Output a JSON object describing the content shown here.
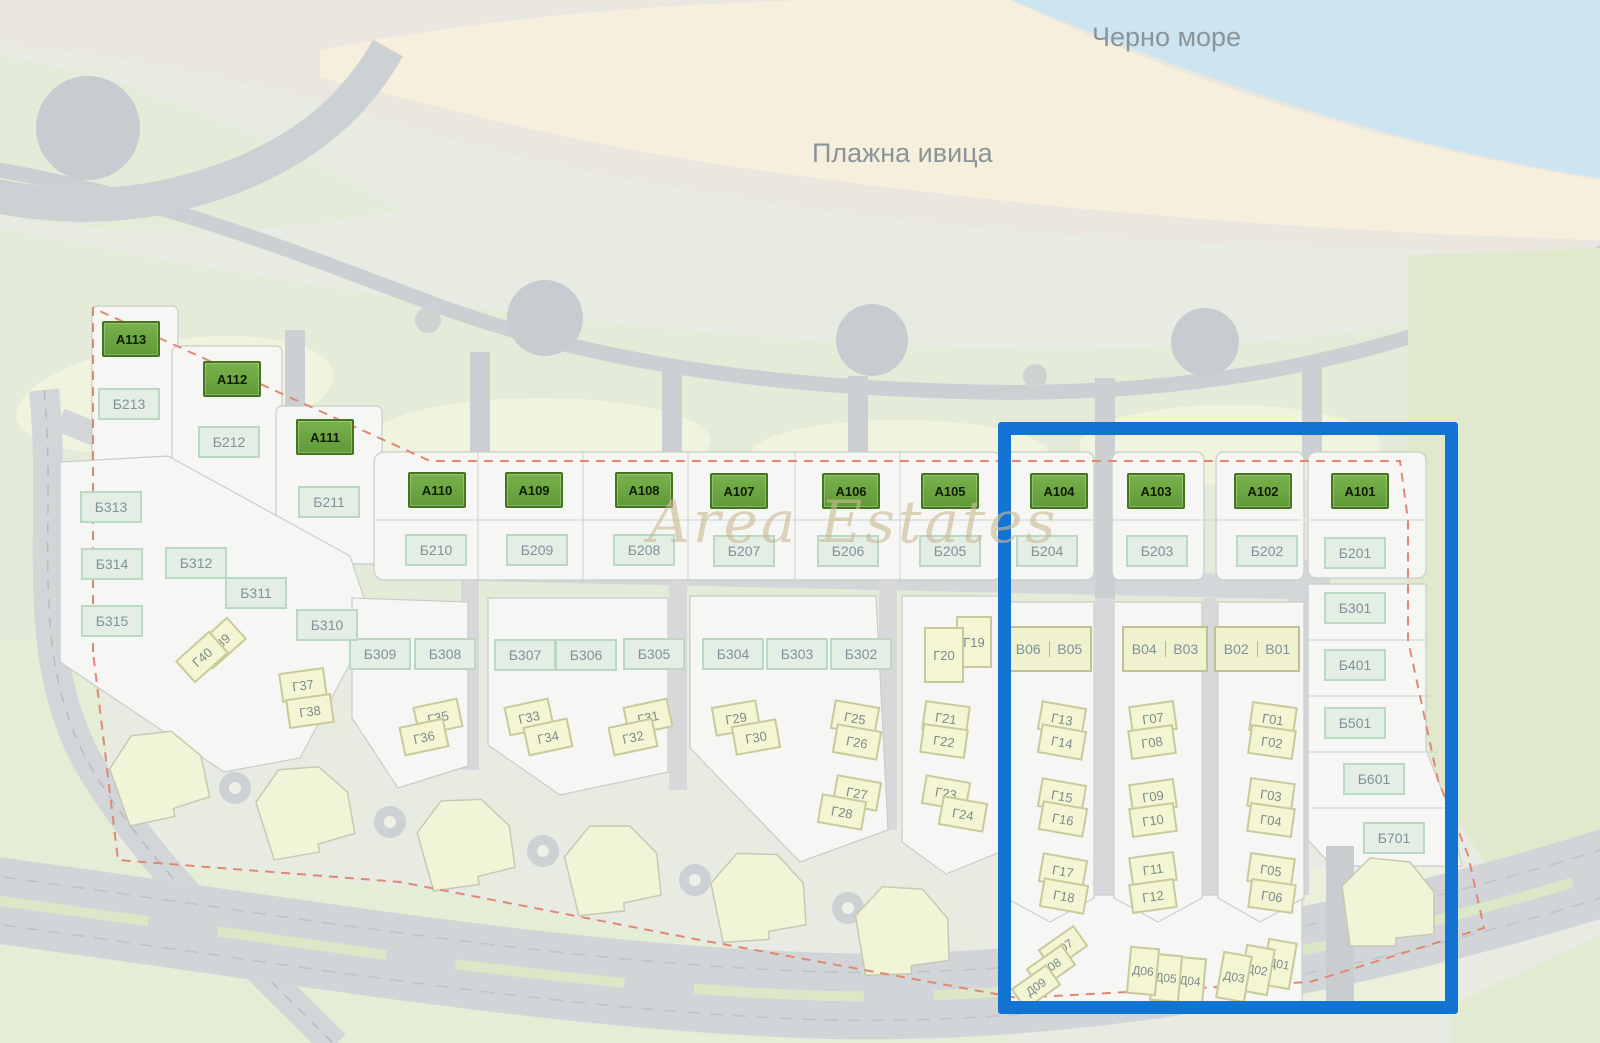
{
  "texts": {
    "sea": "Черно море",
    "beach": "Плажна ивица",
    "watermark": "Area Estates"
  },
  "colors": {
    "sea": "#cde4f1",
    "sand": "#f7efdd",
    "park": "#e4ecd9",
    "road": "#d3d6d8",
    "parcel": "#f6f7f4",
    "building_a": "#69a23e",
    "building_b": "#e3efe5",
    "lot_yellow": "#f4f5d2",
    "highlight_blue": "#1273d2",
    "boundary_red": "#e08875"
  },
  "markers": {
    "a_buildings": [
      {
        "label": "A113",
        "x": 131,
        "y": 339
      },
      {
        "label": "A112",
        "x": 232,
        "y": 379
      },
      {
        "label": "A111",
        "x": 325,
        "y": 437
      },
      {
        "label": "A110",
        "x": 437,
        "y": 490
      },
      {
        "label": "A109",
        "x": 534,
        "y": 490
      },
      {
        "label": "A108",
        "x": 644,
        "y": 490
      },
      {
        "label": "A107",
        "x": 739,
        "y": 491
      },
      {
        "label": "A106",
        "x": 851,
        "y": 491
      },
      {
        "label": "A105",
        "x": 950,
        "y": 491
      },
      {
        "label": "A104",
        "x": 1059,
        "y": 491
      },
      {
        "label": "A103",
        "x": 1156,
        "y": 491
      },
      {
        "label": "A102",
        "x": 1263,
        "y": 491
      },
      {
        "label": "A101",
        "x": 1360,
        "y": 491
      }
    ],
    "b_buildings": [
      {
        "label": "Б213",
        "x": 129,
        "y": 404
      },
      {
        "label": "Б212",
        "x": 229,
        "y": 442
      },
      {
        "label": "Б211",
        "x": 329,
        "y": 502
      },
      {
        "label": "Б210",
        "x": 436,
        "y": 550
      },
      {
        "label": "Б209",
        "x": 537,
        "y": 550
      },
      {
        "label": "Б208",
        "x": 644,
        "y": 550
      },
      {
        "label": "Б207",
        "x": 744,
        "y": 551
      },
      {
        "label": "Б206",
        "x": 848,
        "y": 551
      },
      {
        "label": "Б205",
        "x": 950,
        "y": 551
      },
      {
        "label": "Б204",
        "x": 1047,
        "y": 551
      },
      {
        "label": "Б203",
        "x": 1157,
        "y": 551
      },
      {
        "label": "Б202",
        "x": 1267,
        "y": 551
      },
      {
        "label": "Б201",
        "x": 1355,
        "y": 553
      },
      {
        "label": "Б301",
        "x": 1355,
        "y": 608
      },
      {
        "label": "Б401",
        "x": 1355,
        "y": 665
      },
      {
        "label": "Б501",
        "x": 1355,
        "y": 723
      },
      {
        "label": "Б601",
        "x": 1374,
        "y": 779
      },
      {
        "label": "Б701",
        "x": 1394,
        "y": 838
      },
      {
        "label": "Б302",
        "x": 861,
        "y": 654
      },
      {
        "label": "Б303",
        "x": 797,
        "y": 654
      },
      {
        "label": "Б304",
        "x": 733,
        "y": 654
      },
      {
        "label": "Б305",
        "x": 654,
        "y": 654
      },
      {
        "label": "Б306",
        "x": 586,
        "y": 655
      },
      {
        "label": "Б307",
        "x": 525,
        "y": 655
      },
      {
        "label": "Б308",
        "x": 445,
        "y": 654
      },
      {
        "label": "Б309",
        "x": 380,
        "y": 654
      },
      {
        "label": "Б310",
        "x": 327,
        "y": 625
      },
      {
        "label": "Б311",
        "x": 256,
        "y": 593
      },
      {
        "label": "Б312",
        "x": 196,
        "y": 563
      },
      {
        "label": "Б313",
        "x": 111,
        "y": 507
      },
      {
        "label": "Б314",
        "x": 112,
        "y": 564
      },
      {
        "label": "Б315",
        "x": 112,
        "y": 621
      }
    ],
    "v_duplexes": [
      {
        "labels": [
          "В06",
          "В05"
        ],
        "x": 1049,
        "y": 649
      },
      {
        "labels": [
          "В04",
          "В03"
        ],
        "x": 1165,
        "y": 649
      },
      {
        "labels": [
          "В02",
          "В01"
        ],
        "x": 1257,
        "y": 649
      }
    ],
    "g_lots": [
      {
        "label": "Г01",
        "x": 1273,
        "y": 719,
        "rot": 8
      },
      {
        "label": "Г02",
        "x": 1272,
        "y": 742,
        "rot": 8
      },
      {
        "label": "Г03",
        "x": 1271,
        "y": 795,
        "rot": 8
      },
      {
        "label": "Г04",
        "x": 1271,
        "y": 820,
        "rot": 8
      },
      {
        "label": "Г05",
        "x": 1271,
        "y": 870,
        "rot": 8
      },
      {
        "label": "Г06",
        "x": 1272,
        "y": 896,
        "rot": 8
      },
      {
        "label": "Г07",
        "x": 1153,
        "y": 718,
        "rot": -8
      },
      {
        "label": "Г08",
        "x": 1152,
        "y": 742,
        "rot": -8
      },
      {
        "label": "Г09",
        "x": 1153,
        "y": 796,
        "rot": -8
      },
      {
        "label": "Г10",
        "x": 1153,
        "y": 820,
        "rot": -8
      },
      {
        "label": "Г11",
        "x": 1153,
        "y": 869,
        "rot": -8
      },
      {
        "label": "Г12",
        "x": 1153,
        "y": 896,
        "rot": -8
      },
      {
        "label": "Г13",
        "x": 1062,
        "y": 719,
        "rot": 10
      },
      {
        "label": "Г14",
        "x": 1062,
        "y": 742,
        "rot": 10
      },
      {
        "label": "Г15",
        "x": 1062,
        "y": 796,
        "rot": 10
      },
      {
        "label": "Г16",
        "x": 1063,
        "y": 819,
        "rot": 10
      },
      {
        "label": "Г17",
        "x": 1063,
        "y": 871,
        "rot": 10
      },
      {
        "label": "Г18",
        "x": 1064,
        "y": 896,
        "rot": 10
      },
      {
        "label": "Г19",
        "x": 974,
        "y": 642,
        "rot": 0,
        "w": 36,
        "h": 52
      },
      {
        "label": "Г20",
        "x": 944,
        "y": 655,
        "rot": 0,
        "w": 40,
        "h": 56
      },
      {
        "label": "Г21",
        "x": 946,
        "y": 718,
        "rot": 8
      },
      {
        "label": "Г22",
        "x": 944,
        "y": 741,
        "rot": 8
      },
      {
        "label": "Г23",
        "x": 946,
        "y": 793,
        "rot": 10
      },
      {
        "label": "Г24",
        "x": 963,
        "y": 814,
        "rot": 10
      },
      {
        "label": "Г25",
        "x": 855,
        "y": 718,
        "rot": 10
      },
      {
        "label": "Г26",
        "x": 857,
        "y": 742,
        "rot": 10
      },
      {
        "label": "Г27",
        "x": 857,
        "y": 793,
        "rot": 10
      },
      {
        "label": "Г28",
        "x": 842,
        "y": 812,
        "rot": 10
      },
      {
        "label": "Г29",
        "x": 736,
        "y": 718,
        "rot": -10
      },
      {
        "label": "Г30",
        "x": 756,
        "y": 737,
        "rot": -10
      },
      {
        "label": "Г31",
        "x": 648,
        "y": 717,
        "rot": -12
      },
      {
        "label": "Г32",
        "x": 633,
        "y": 737,
        "rot": -12
      },
      {
        "label": "Г33",
        "x": 529,
        "y": 717,
        "rot": -12
      },
      {
        "label": "Г34",
        "x": 548,
        "y": 737,
        "rot": -12
      },
      {
        "label": "Г35",
        "x": 438,
        "y": 717,
        "rot": -12
      },
      {
        "label": "Г36",
        "x": 424,
        "y": 737,
        "rot": -12
      },
      {
        "label": "Г37",
        "x": 303,
        "y": 685,
        "rot": -8
      },
      {
        "label": "Г38",
        "x": 310,
        "y": 711,
        "rot": -8
      },
      {
        "label": "Г39",
        "x": 220,
        "y": 643,
        "rot": -42
      },
      {
        "label": "Г40",
        "x": 202,
        "y": 657,
        "rot": -42
      }
    ],
    "d_lots": [
      {
        "label": "Д01",
        "x": 1279,
        "y": 964,
        "rot": 10
      },
      {
        "label": "Д02",
        "x": 1257,
        "y": 970,
        "rot": 10
      },
      {
        "label": "Д03",
        "x": 1234,
        "y": 977,
        "rot": 10
      },
      {
        "label": "Д04",
        "x": 1190,
        "y": 981,
        "rot": 5
      },
      {
        "label": "Д05",
        "x": 1166,
        "y": 978,
        "rot": 5
      },
      {
        "label": "Д06",
        "x": 1143,
        "y": 971,
        "rot": 5
      },
      {
        "label": "Д07",
        "x": 1063,
        "y": 948,
        "rot": -35,
        "w": 44,
        "h": 26
      },
      {
        "label": "Д08",
        "x": 1051,
        "y": 967,
        "rot": -35,
        "w": 44,
        "h": 26
      },
      {
        "label": "Д09",
        "x": 1036,
        "y": 987,
        "rot": -35,
        "w": 44,
        "h": 26
      }
    ]
  }
}
